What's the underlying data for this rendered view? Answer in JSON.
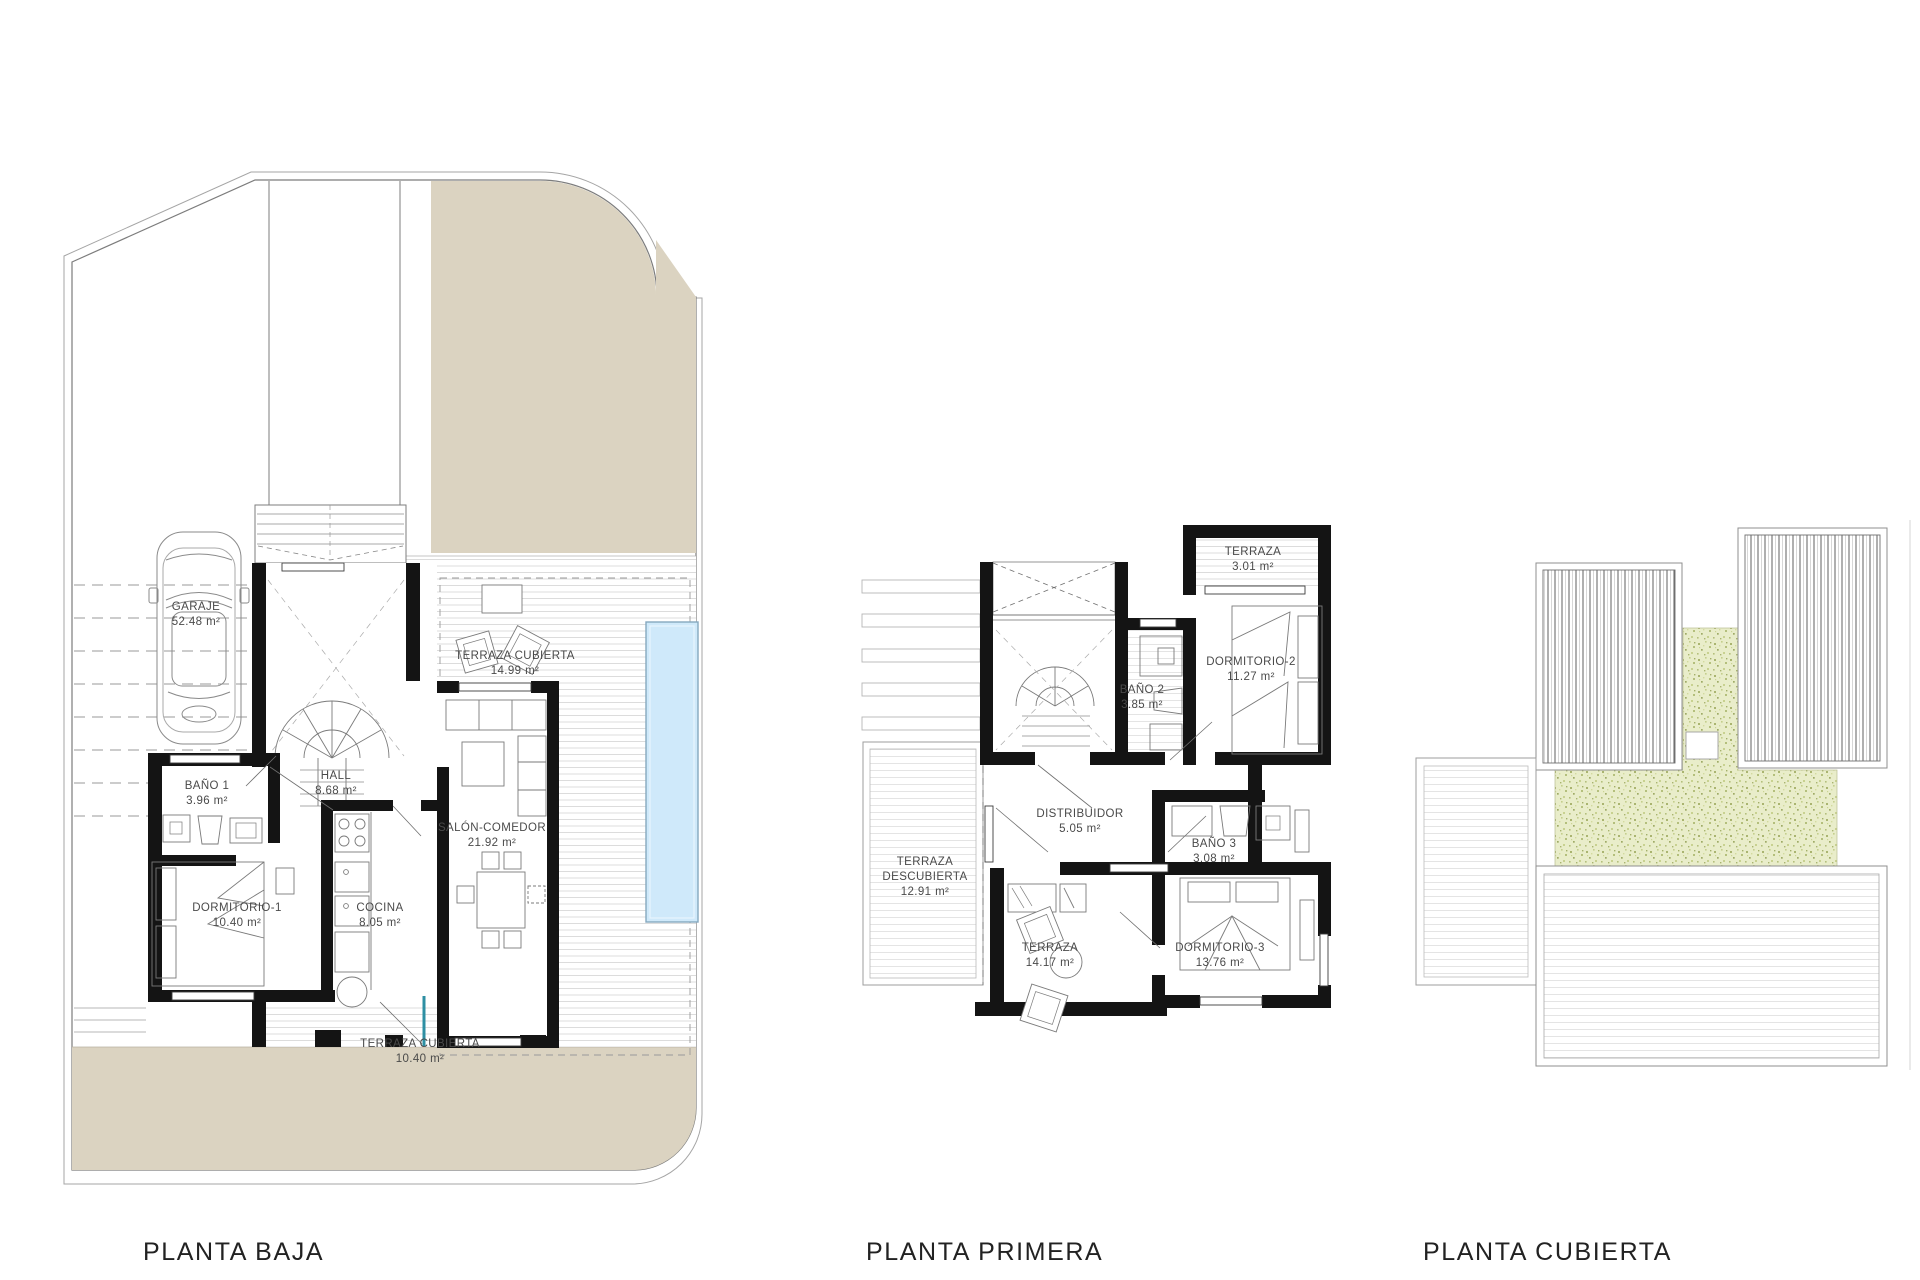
{
  "document": {
    "type": "architectural-floorplan-sheet",
    "background": "#ffffff"
  },
  "colors": {
    "patio_beige": "#dbd3c1",
    "grass_green": "#e9edca",
    "pool_blue": "#cfe9fa",
    "wall_black": "#141414",
    "deck_stripe": "#dcdcdc",
    "accent_door_teal": "#2e8fa3",
    "label_text": "#4a4a4a"
  },
  "plans": [
    {
      "id": "planta-baja",
      "title": "PLANTA BAJA",
      "rooms": [
        {
          "name": "GARAJE",
          "area": "52.48 m²"
        },
        {
          "name": "TERRAZA CUBIERTA",
          "area": "14.99 m²"
        },
        {
          "name": "HALL",
          "area": "8.68 m²"
        },
        {
          "name": "BAÑO 1",
          "area": "3.96 m²"
        },
        {
          "name": "DORMITORIO-1",
          "area": "10.40 m²"
        },
        {
          "name": "COCINA",
          "area": "8.05 m²"
        },
        {
          "name": "SALÓN-COMEDOR",
          "area": "21.92 m²"
        },
        {
          "name": "TERRAZA CUBIERTA",
          "area": "10.40 m²"
        }
      ]
    },
    {
      "id": "planta-primera",
      "title": "PLANTA PRIMERA",
      "rooms": [
        {
          "name": "TERRAZA",
          "area": "3.01 m²"
        },
        {
          "name": "BAÑO 2",
          "area": "3.85 m²"
        },
        {
          "name": "DORMITORIO-2",
          "area": "11.27 m²"
        },
        {
          "name": "DISTRIBUIDOR",
          "area": "5.05 m²"
        },
        {
          "name": "BAÑO 3",
          "area": "3.08 m²"
        },
        {
          "name": "TERRAZA DESCUBIERTA",
          "area": "12.91 m²"
        },
        {
          "name": "TERRAZA",
          "area": "14.17 m²"
        },
        {
          "name": "DORMITORIO-3",
          "area": "13.76 m²"
        }
      ]
    },
    {
      "id": "planta-cubierta",
      "title": "PLANTA CUBIERTA",
      "rooms": []
    }
  ]
}
